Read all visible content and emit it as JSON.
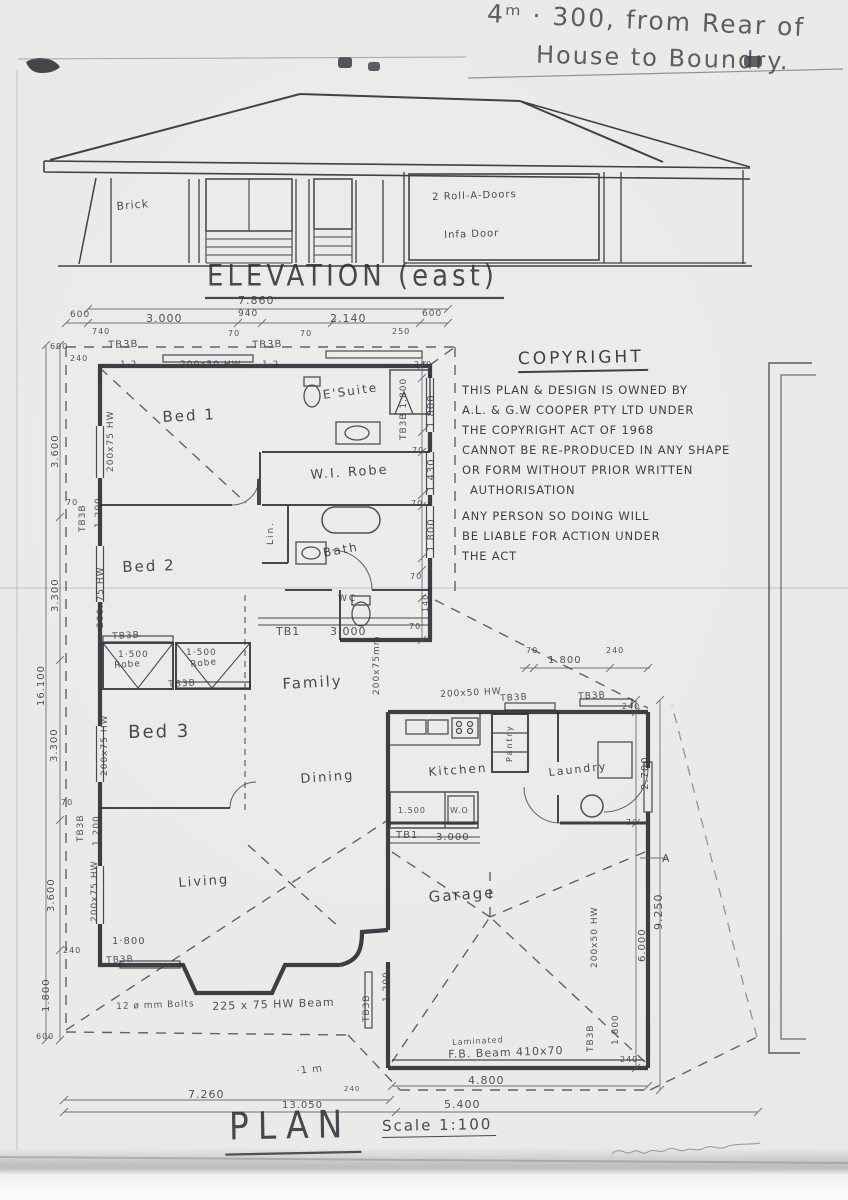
{
  "paper_color": "#eaebe9",
  "ink_color": "#2d2d35",
  "note": {
    "line1": "4ᵐ · 300, from Rear of",
    "line2": "House to Boundry."
  },
  "elevation": {
    "title": "ELEVATION (east)",
    "labels": [
      {
        "t": "Brick",
        "x": 116,
        "y": 200,
        "s": 11,
        "r": -5
      },
      {
        "t": "2  Roll-A-Doors",
        "x": 432,
        "y": 192,
        "s": 10,
        "r": -2
      },
      {
        "t": "Infa Door",
        "x": 444,
        "y": 230,
        "s": 10,
        "r": -2
      }
    ]
  },
  "copyright": {
    "title": "COPYRIGHT",
    "lines": [
      "THIS PLAN & DESIGN IS OWNED BY",
      "A.L. & G.W COOPER PTY LTD    UNDER",
      "THE COPYRIGHT ACT OF 1968",
      "CANNOT BE RE-PRODUCED IN ANY SHAPE",
      "OR FORM WITHOUT PRIOR WRITTEN",
      "AUTHORISATION",
      "ANY PERSON  SO DOING WILL",
      "BE LIABLE  FOR ACTION  UNDER",
      "THE ACT"
    ]
  },
  "plan": {
    "title": "PLAN",
    "scale_label": "Scale 1:100",
    "room_labels": [
      {
        "t": "Bed 1",
        "x": 162,
        "y": 408,
        "s": 15,
        "r": -3
      },
      {
        "t": "Bed 2",
        "x": 122,
        "y": 558,
        "s": 15,
        "r": -2
      },
      {
        "t": "Bed 3",
        "x": 128,
        "y": 722,
        "s": 18,
        "r": -1
      },
      {
        "t": "E'Suite",
        "x": 322,
        "y": 388,
        "s": 12,
        "r": -8
      },
      {
        "t": "W.I. Robe",
        "x": 310,
        "y": 468,
        "s": 13,
        "r": -4
      },
      {
        "t": "Bath",
        "x": 322,
        "y": 546,
        "s": 12,
        "r": -10
      },
      {
        "t": "Lin.",
        "x": 266,
        "y": 545,
        "s": 9,
        "v": 1
      },
      {
        "t": "WC",
        "x": 338,
        "y": 594,
        "s": 9
      },
      {
        "t": "Family",
        "x": 282,
        "y": 675,
        "s": 15,
        "r": -3
      },
      {
        "t": "Dining",
        "x": 300,
        "y": 772,
        "s": 13,
        "r": -4
      },
      {
        "t": "Living",
        "x": 178,
        "y": 876,
        "s": 13,
        "r": -4
      },
      {
        "t": "Kitchen",
        "x": 428,
        "y": 765,
        "s": 12,
        "r": -4
      },
      {
        "t": "Laundry",
        "x": 548,
        "y": 766,
        "s": 11,
        "r": -6
      },
      {
        "t": "Pantry",
        "x": 505,
        "y": 762,
        "s": 8,
        "v": 1
      },
      {
        "t": "Garage",
        "x": 428,
        "y": 888,
        "s": 15,
        "r": -4
      }
    ],
    "dim_labels": [
      {
        "t": "7.860",
        "x": 238,
        "y": 294,
        "s": 11
      },
      {
        "t": "600",
        "x": 70,
        "y": 310,
        "s": 9
      },
      {
        "t": "3.000",
        "x": 146,
        "y": 312,
        "s": 11
      },
      {
        "t": "940",
        "x": 238,
        "y": 309,
        "s": 9
      },
      {
        "t": "2.140",
        "x": 330,
        "y": 312,
        "s": 11
      },
      {
        "t": "600",
        "x": 422,
        "y": 309,
        "s": 9
      },
      {
        "t": "740",
        "x": 92,
        "y": 327,
        "s": 8
      },
      {
        "t": "70",
        "x": 228,
        "y": 329,
        "s": 8
      },
      {
        "t": "70",
        "x": 300,
        "y": 329,
        "s": 8
      },
      {
        "t": "250",
        "x": 392,
        "y": 327,
        "s": 8
      },
      {
        "t": "TB3B",
        "x": 108,
        "y": 340,
        "s": 10,
        "r": -2
      },
      {
        "t": "TB3B",
        "x": 252,
        "y": 340,
        "s": 10,
        "r": -2
      },
      {
        "t": "1·2",
        "x": 120,
        "y": 360,
        "s": 9
      },
      {
        "t": "200x50 HW",
        "x": 180,
        "y": 360,
        "s": 9
      },
      {
        "t": "1·2",
        "x": 262,
        "y": 360,
        "s": 9
      },
      {
        "t": "240",
        "x": 414,
        "y": 360,
        "s": 8
      },
      {
        "t": "TB3B 1.800",
        "x": 399,
        "y": 440,
        "s": 9,
        "v": 1
      },
      {
        "t": "1.800",
        "x": 426,
        "y": 428,
        "s": 10,
        "v": 1
      },
      {
        "t": "70",
        "x": 412,
        "y": 446,
        "s": 8
      },
      {
        "t": "1.430",
        "x": 426,
        "y": 492,
        "s": 10,
        "v": 1
      },
      {
        "t": "70",
        "x": 411,
        "y": 499,
        "s": 8
      },
      {
        "t": "1.800",
        "x": 426,
        "y": 552,
        "s": 10,
        "v": 1
      },
      {
        "t": "70",
        "x": 410,
        "y": 572,
        "s": 8
      },
      {
        "t": "140",
        "x": 421,
        "y": 612,
        "s": 8,
        "v": 1
      },
      {
        "t": "70",
        "x": 409,
        "y": 622,
        "s": 8
      },
      {
        "t": "600",
        "x": 50,
        "y": 342,
        "s": 8
      },
      {
        "t": "240",
        "x": 70,
        "y": 354,
        "s": 8
      },
      {
        "t": "3.600",
        "x": 50,
        "y": 468,
        "s": 10,
        "v": 1
      },
      {
        "t": "70",
        "x": 66,
        "y": 498,
        "s": 8
      },
      {
        "t": "TB3B",
        "x": 78,
        "y": 532,
        "s": 9,
        "v": 1
      },
      {
        "t": "1.200",
        "x": 94,
        "y": 528,
        "s": 9,
        "v": 1
      },
      {
        "t": "200x75 HW",
        "x": 106,
        "y": 472,
        "s": 9,
        "v": 1
      },
      {
        "t": "3.300",
        "x": 50,
        "y": 612,
        "s": 10,
        "v": 1
      },
      {
        "t": "16.100",
        "x": 36,
        "y": 706,
        "s": 10,
        "v": 1
      },
      {
        "t": "200x75 HW",
        "x": 96,
        "y": 628,
        "s": 9,
        "v": 1
      },
      {
        "t": "3.300",
        "x": 49,
        "y": 762,
        "s": 10,
        "v": 1
      },
      {
        "t": "200x75 HW",
        "x": 100,
        "y": 776,
        "s": 9,
        "v": 1
      },
      {
        "t": "70",
        "x": 61,
        "y": 798,
        "s": 8
      },
      {
        "t": "TB3B",
        "x": 76,
        "y": 842,
        "s": 9,
        "v": 1
      },
      {
        "t": "1.200",
        "x": 92,
        "y": 846,
        "s": 9,
        "v": 1
      },
      {
        "t": "3.600",
        "x": 46,
        "y": 912,
        "s": 10,
        "v": 1
      },
      {
        "t": "200x75 HW",
        "x": 90,
        "y": 922,
        "s": 9,
        "v": 1
      },
      {
        "t": "240",
        "x": 63,
        "y": 946,
        "s": 8
      },
      {
        "t": "1.800",
        "x": 41,
        "y": 1012,
        "s": 10,
        "v": 1
      },
      {
        "t": "600",
        "x": 36,
        "y": 1032,
        "s": 8
      },
      {
        "t": "TB3B",
        "x": 112,
        "y": 632,
        "s": 9,
        "r": -3
      },
      {
        "t": "1·500",
        "x": 118,
        "y": 650,
        "s": 9
      },
      {
        "t": "Robe",
        "x": 114,
        "y": 661,
        "s": 9,
        "r": -4
      },
      {
        "t": "1·500",
        "x": 186,
        "y": 648,
        "s": 9
      },
      {
        "t": "Robe",
        "x": 190,
        "y": 660,
        "s": 9,
        "r": -6
      },
      {
        "t": "TB3B",
        "x": 168,
        "y": 680,
        "s": 9,
        "r": -3
      },
      {
        "t": "TB1",
        "x": 276,
        "y": 625,
        "s": 11
      },
      {
        "t": "3.000",
        "x": 330,
        "y": 625,
        "s": 11
      },
      {
        "t": "200x75mm",
        "x": 372,
        "y": 695,
        "s": 9,
        "v": 1
      },
      {
        "t": "70",
        "x": 526,
        "y": 646,
        "s": 8
      },
      {
        "t": "1.800",
        "x": 548,
        "y": 655,
        "s": 10
      },
      {
        "t": "240",
        "x": 606,
        "y": 646,
        "s": 8
      },
      {
        "t": "200x50 HW",
        "x": 440,
        "y": 690,
        "s": 9,
        "r": -3
      },
      {
        "t": "TB3B",
        "x": 500,
        "y": 694,
        "s": 9,
        "r": -3
      },
      {
        "t": "TB3B",
        "x": 578,
        "y": 692,
        "s": 9,
        "r": -3
      },
      {
        "t": "1.500",
        "x": 398,
        "y": 806,
        "s": 8
      },
      {
        "t": "W.O",
        "x": 450,
        "y": 806,
        "s": 8
      },
      {
        "t": "TB1",
        "x": 396,
        "y": 830,
        "s": 10
      },
      {
        "t": "3.000",
        "x": 436,
        "y": 832,
        "s": 10
      },
      {
        "t": "240",
        "x": 622,
        "y": 702,
        "s": 8
      },
      {
        "t": "2.700",
        "x": 640,
        "y": 790,
        "s": 10,
        "v": 1
      },
      {
        "t": "70",
        "x": 626,
        "y": 818,
        "s": 8
      },
      {
        "t": "A",
        "x": 662,
        "y": 852,
        "s": 11
      },
      {
        "t": "6.000",
        "x": 637,
        "y": 962,
        "s": 10,
        "v": 1
      },
      {
        "t": "9.250",
        "x": 652,
        "y": 930,
        "s": 11,
        "v": 1
      },
      {
        "t": "200x50 HW",
        "x": 590,
        "y": 968,
        "s": 9,
        "v": 1
      },
      {
        "t": "TB3B",
        "x": 586,
        "y": 1052,
        "s": 9,
        "v": 1
      },
      {
        "t": "1.800",
        "x": 611,
        "y": 1045,
        "s": 9,
        "v": 1
      },
      {
        "t": "240",
        "x": 620,
        "y": 1055,
        "s": 8
      },
      {
        "t": "1·800",
        "x": 112,
        "y": 936,
        "s": 10
      },
      {
        "t": "TB3B",
        "x": 106,
        "y": 956,
        "s": 9,
        "r": -3
      },
      {
        "t": "12 ø mm Bolts",
        "x": 116,
        "y": 1002,
        "s": 9,
        "r": -2
      },
      {
        "t": "225 x 75 HW Beam",
        "x": 212,
        "y": 1000,
        "s": 11,
        "r": -2
      },
      {
        "t": "TB3B",
        "x": 362,
        "y": 1022,
        "s": 9,
        "v": 1
      },
      {
        "t": "1.200",
        "x": 382,
        "y": 1002,
        "s": 9,
        "v": 1
      },
      {
        "t": "Laminated",
        "x": 452,
        "y": 1038,
        "s": 8,
        "r": -3
      },
      {
        "t": "F.B. Beam 410x70",
        "x": 448,
        "y": 1048,
        "s": 11,
        "r": -2
      },
      {
        "t": "4.800",
        "x": 468,
        "y": 1074,
        "s": 11
      },
      {
        "t": "240",
        "x": 344,
        "y": 1085,
        "s": 7
      },
      {
        "t": "·1 m",
        "x": 296,
        "y": 1066,
        "s": 10,
        "r": -6
      },
      {
        "t": "7.260",
        "x": 188,
        "y": 1088,
        "s": 11
      },
      {
        "t": "13.050",
        "x": 282,
        "y": 1100,
        "s": 10
      },
      {
        "t": "5.400",
        "x": 444,
        "y": 1098,
        "s": 11
      }
    ]
  }
}
